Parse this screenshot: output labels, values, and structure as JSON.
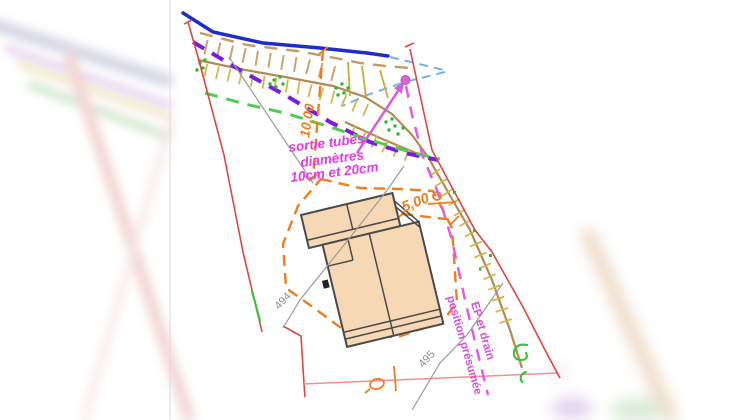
{
  "document": {
    "type": "site-plan drawing (plan de masse)",
    "background": "#ffffff"
  },
  "annotations": {
    "outlet_note": {
      "line1": "sortie tubes",
      "line2": "diamètres",
      "line3": "10cm et 20cm"
    },
    "dimension_top": "10,00",
    "dimension_right": "5,00",
    "contour_left": "494",
    "contour_bottom": "495",
    "drain_note": {
      "line1": "EP et drain",
      "line2": "position présumée"
    }
  },
  "colors": {
    "stream_blue": "#1e2ccc",
    "stream_dashed_blue": "#74b2e8",
    "slope_tan_solid": "#b38b52",
    "slope_tan_dashed": "#c49a62",
    "hachure_yellow": "#d2b244",
    "pipeline_purple": "#7a1ae6",
    "limit_green_dashed": "#4ece4e",
    "vegetation_green": "#2eb82e",
    "boundary_red": "#e04545",
    "boundary_pink": "#f09090",
    "earthwork_orange": "#ef7d1e",
    "drain_magenta": "#e05ce0",
    "note_magenta": "#e23ce2",
    "contour_gray": "#9b9b9b",
    "building_fill": "#f6d8b4",
    "building_outline": "#4a4a4a"
  }
}
